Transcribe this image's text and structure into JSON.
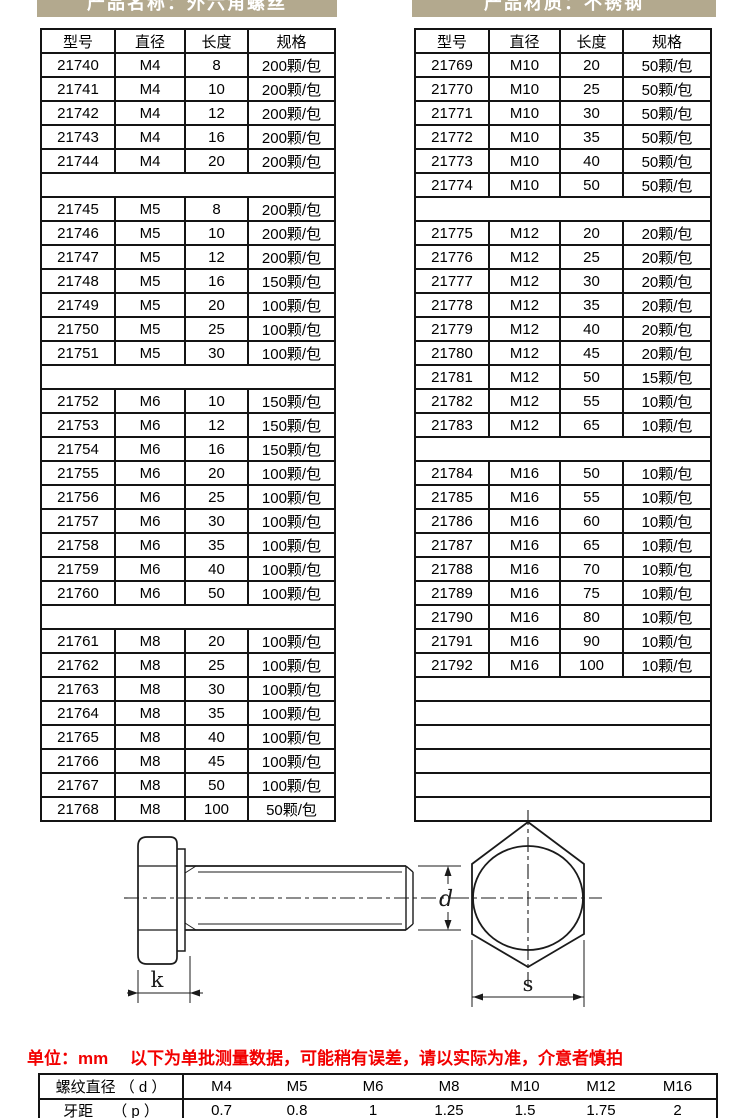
{
  "banners": {
    "left": "产品名称：外六角螺丝",
    "right": "产品材质：不锈钢",
    "bg_color": "#b3a98e",
    "text_color": "#ffffff"
  },
  "product_tables": {
    "headers": [
      "型号",
      "直径",
      "长度",
      "规格"
    ],
    "left_rows": [
      [
        "21740",
        "M4",
        "8",
        "200颗/包"
      ],
      [
        "21741",
        "M4",
        "10",
        "200颗/包"
      ],
      [
        "21742",
        "M4",
        "12",
        "200颗/包"
      ],
      [
        "21743",
        "M4",
        "16",
        "200颗/包"
      ],
      [
        "21744",
        "M4",
        "20",
        "200颗/包"
      ],
      [],
      [
        "21745",
        "M5",
        "8",
        "200颗/包"
      ],
      [
        "21746",
        "M5",
        "10",
        "200颗/包"
      ],
      [
        "21747",
        "M5",
        "12",
        "200颗/包"
      ],
      [
        "21748",
        "M5",
        "16",
        "150颗/包"
      ],
      [
        "21749",
        "M5",
        "20",
        "100颗/包"
      ],
      [
        "21750",
        "M5",
        "25",
        "100颗/包"
      ],
      [
        "21751",
        "M5",
        "30",
        "100颗/包"
      ],
      [],
      [
        "21752",
        "M6",
        "10",
        "150颗/包"
      ],
      [
        "21753",
        "M6",
        "12",
        "150颗/包"
      ],
      [
        "21754",
        "M6",
        "16",
        "150颗/包"
      ],
      [
        "21755",
        "M6",
        "20",
        "100颗/包"
      ],
      [
        "21756",
        "M6",
        "25",
        "100颗/包"
      ],
      [
        "21757",
        "M6",
        "30",
        "100颗/包"
      ],
      [
        "21758",
        "M6",
        "35",
        "100颗/包"
      ],
      [
        "21759",
        "M6",
        "40",
        "100颗/包"
      ],
      [
        "21760",
        "M6",
        "50",
        "100颗/包"
      ],
      [],
      [
        "21761",
        "M8",
        "20",
        "100颗/包"
      ],
      [
        "21762",
        "M8",
        "25",
        "100颗/包"
      ],
      [
        "21763",
        "M8",
        "30",
        "100颗/包"
      ],
      [
        "21764",
        "M8",
        "35",
        "100颗/包"
      ],
      [
        "21765",
        "M8",
        "40",
        "100颗/包"
      ],
      [
        "21766",
        "M8",
        "45",
        "100颗/包"
      ],
      [
        "21767",
        "M8",
        "50",
        "100颗/包"
      ],
      [
        "21768",
        "M8",
        "100",
        "50颗/包"
      ]
    ],
    "right_rows": [
      [
        "21769",
        "M10",
        "20",
        "50颗/包"
      ],
      [
        "21770",
        "M10",
        "25",
        "50颗/包"
      ],
      [
        "21771",
        "M10",
        "30",
        "50颗/包"
      ],
      [
        "21772",
        "M10",
        "35",
        "50颗/包"
      ],
      [
        "21773",
        "M10",
        "40",
        "50颗/包"
      ],
      [
        "21774",
        "M10",
        "50",
        "50颗/包"
      ],
      [],
      [
        "21775",
        "M12",
        "20",
        "20颗/包"
      ],
      [
        "21776",
        "M12",
        "25",
        "20颗/包"
      ],
      [
        "21777",
        "M12",
        "30",
        "20颗/包"
      ],
      [
        "21778",
        "M12",
        "35",
        "20颗/包"
      ],
      [
        "21779",
        "M12",
        "40",
        "20颗/包"
      ],
      [
        "21780",
        "M12",
        "45",
        "20颗/包"
      ],
      [
        "21781",
        "M12",
        "50",
        "15颗/包"
      ],
      [
        "21782",
        "M12",
        "55",
        "10颗/包"
      ],
      [
        "21783",
        "M12",
        "65",
        "10颗/包"
      ],
      [],
      [
        "21784",
        "M16",
        "50",
        "10颗/包"
      ],
      [
        "21785",
        "M16",
        "55",
        "10颗/包"
      ],
      [
        "21786",
        "M16",
        "60",
        "10颗/包"
      ],
      [
        "21787",
        "M16",
        "65",
        "10颗/包"
      ],
      [
        "21788",
        "M16",
        "70",
        "10颗/包"
      ],
      [
        "21789",
        "M16",
        "75",
        "10颗/包"
      ],
      [
        "21790",
        "M16",
        "80",
        "10颗/包"
      ],
      [
        "21791",
        "M16",
        "90",
        "10颗/包"
      ],
      [
        "21792",
        "M16",
        "100",
        "10颗/包"
      ],
      [],
      [],
      [],
      [],
      [],
      []
    ]
  },
  "drawing": {
    "labels": {
      "k": "k",
      "d": "d",
      "s": "s"
    }
  },
  "note": {
    "text": "单位：mm　 以下为单批测量数据，可能稍有误差，请以实际为准，介意者慎拍",
    "color": "#f20000"
  },
  "spec_table": {
    "rows": [
      [
        "螺纹直径 （ d ）",
        "M4",
        "M5",
        "M6",
        "M8",
        "M10",
        "M12",
        "M16"
      ],
      [
        "牙距　 （ p ）",
        "0.7",
        "0.8",
        "1",
        "1.25",
        "1.5",
        "1.75",
        "2"
      ]
    ]
  }
}
